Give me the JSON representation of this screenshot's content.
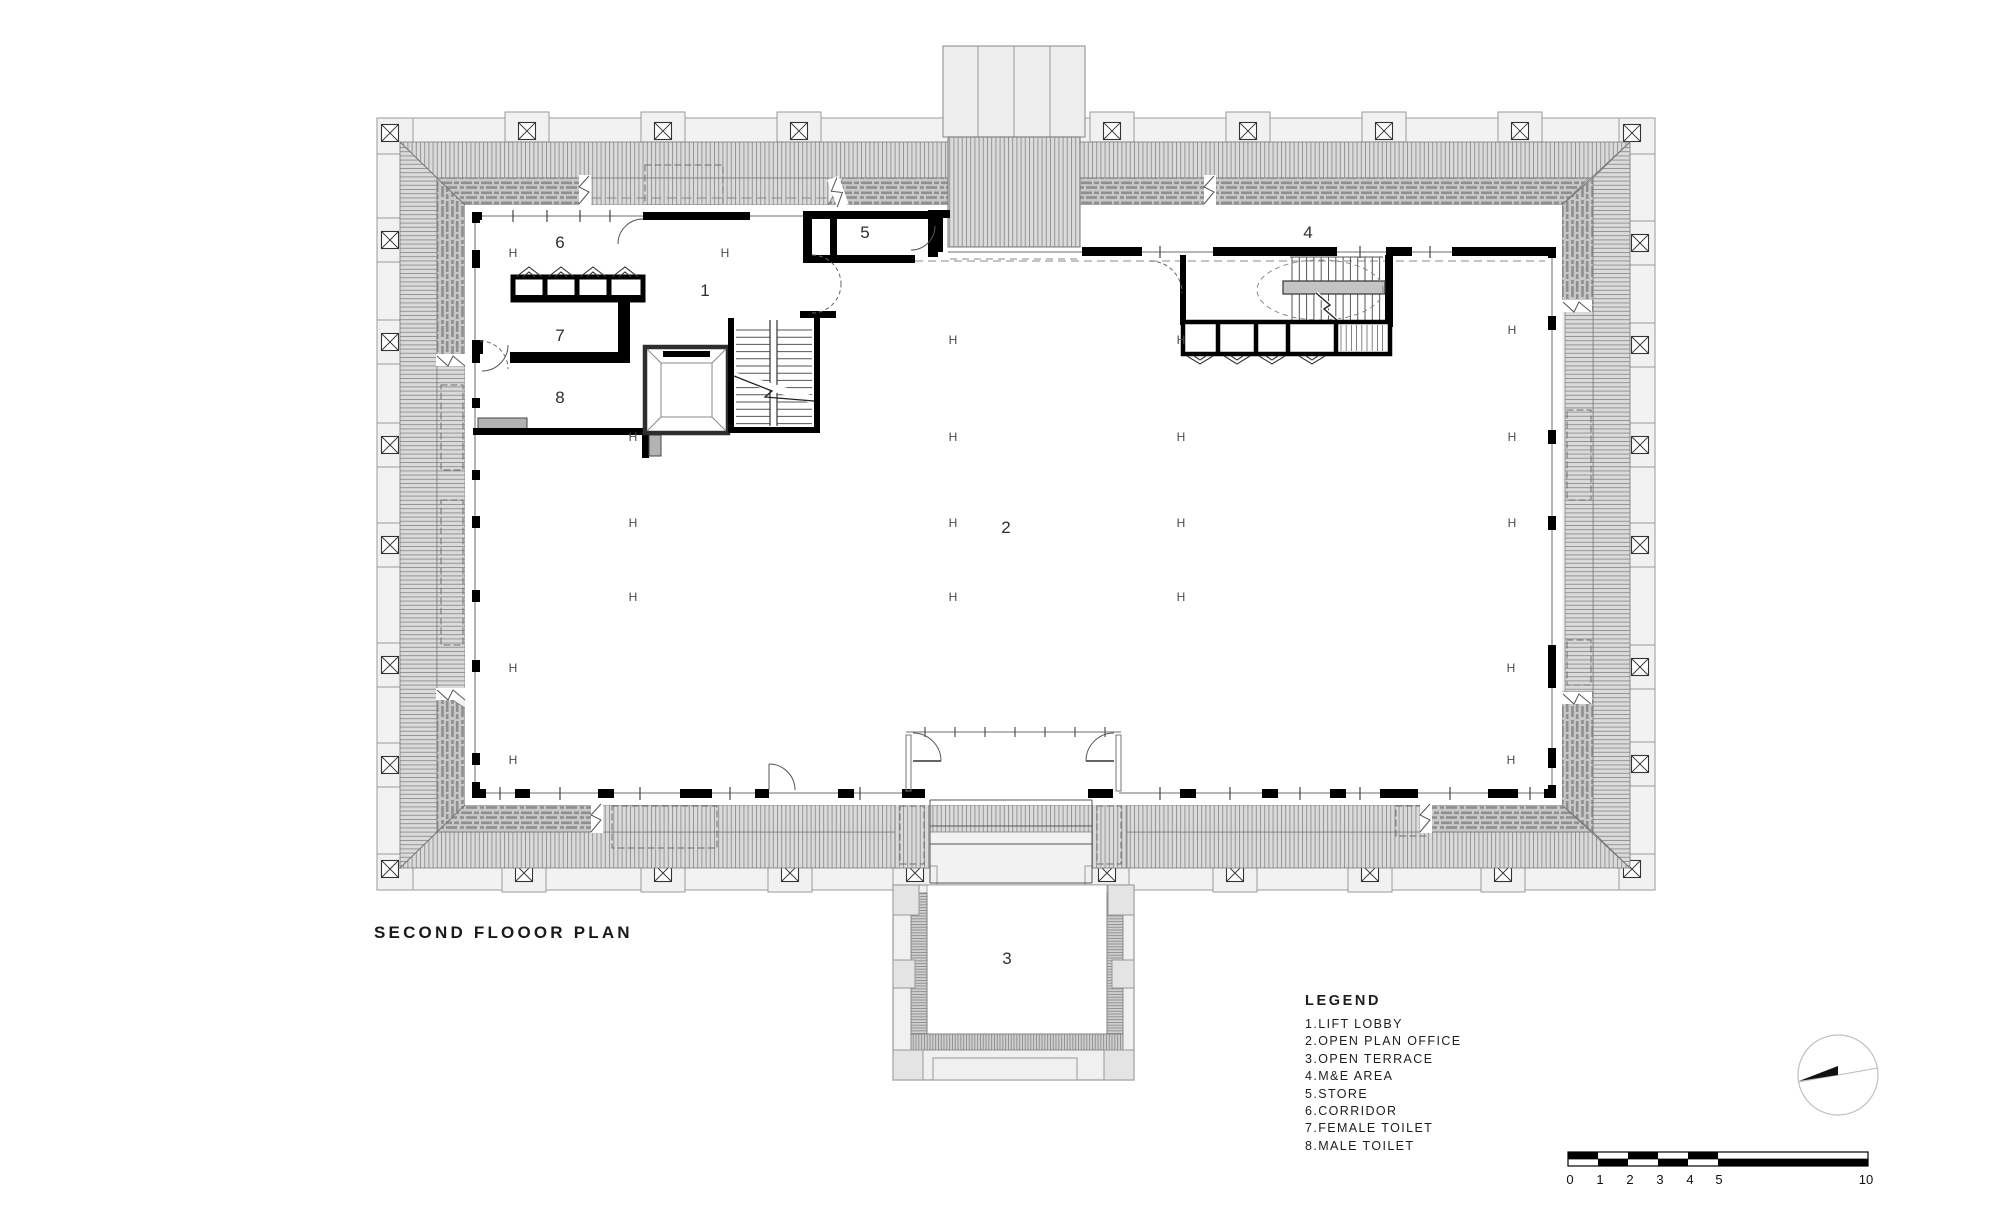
{
  "title": "SECOND FLOOOR PLAN",
  "legend": {
    "heading": "LEGEND",
    "items": [
      "1.LIFT LOBBY",
      "2.OPEN PLAN OFFICE",
      "3.OPEN TERRACE",
      "4.M&E AREA",
      "5.STORE",
      "6.CORRIDOR",
      "7.FEMALE TOILET",
      "8.MALE TOILET"
    ]
  },
  "rooms": [
    {
      "number": "1",
      "name": "LIFT LOBBY"
    },
    {
      "number": "2",
      "name": "OPEN PLAN OFFICE"
    },
    {
      "number": "3",
      "name": "OPEN TERRACE"
    },
    {
      "number": "4",
      "name": "M&E AREA"
    },
    {
      "number": "5",
      "name": "STORE"
    },
    {
      "number": "6",
      "name": "CORRIDOR"
    },
    {
      "number": "7",
      "name": "FEMALE TOILET"
    },
    {
      "number": "8",
      "name": "MALE TOILET"
    }
  ],
  "scalebar": {
    "labels": [
      "0",
      "1",
      "2",
      "3",
      "4",
      "5",
      "10"
    ]
  },
  "plan": {
    "column_marker_glyph": "H",
    "column_markers": [
      [
        513,
        253
      ],
      [
        725,
        253
      ],
      [
        953,
        340
      ],
      [
        1181,
        340
      ],
      [
        1512,
        330
      ],
      [
        633,
        437
      ],
      [
        953,
        437
      ],
      [
        1181,
        437
      ],
      [
        1512,
        437
      ],
      [
        633,
        523
      ],
      [
        953,
        523
      ],
      [
        1181,
        523
      ],
      [
        1512,
        523
      ],
      [
        633,
        597
      ],
      [
        953,
        597
      ],
      [
        1181,
        597
      ],
      [
        513,
        668
      ],
      [
        1511,
        668
      ],
      [
        513,
        760
      ],
      [
        1511,
        760
      ]
    ]
  },
  "colors": {
    "wall": "#000000",
    "line_dark": "#333333",
    "line_mid": "#777777",
    "roof_fill": "#dadada",
    "roof_line": "#8e8e8e",
    "brick_fill": "#c8c8c8",
    "brick_dash": "#979797",
    "band_fill": "#f1f1f1",
    "gray_block": "#b3b3b3",
    "text": "#1d1d1d"
  }
}
